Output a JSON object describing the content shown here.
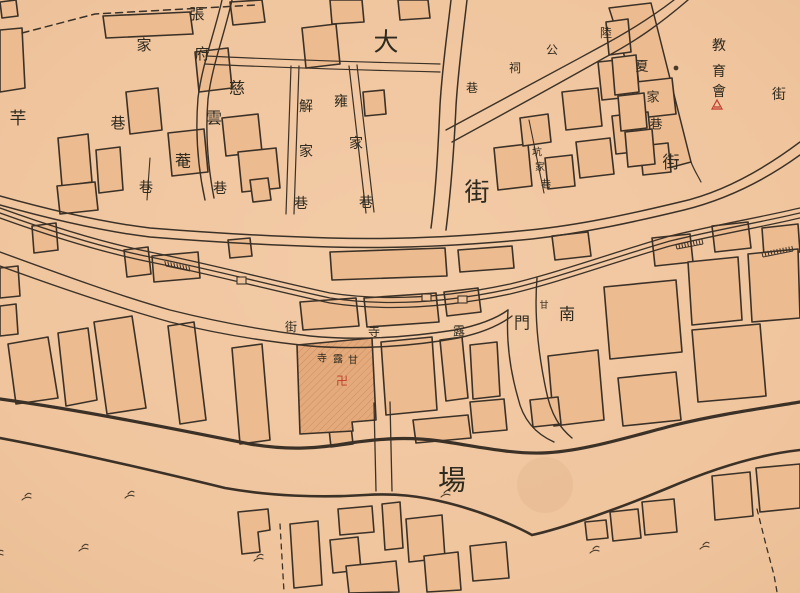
{
  "map": {
    "type": "historical-city-map",
    "colors": {
      "paper": "#f0c59e",
      "paper_light": "#f2cba6",
      "ink": "#3b3127",
      "label_ink": "#2f2a1f",
      "building_fill": "#edbb90",
      "temple_fill": "#e4aa7b",
      "accent_red": "#c03a2b"
    }
  },
  "labels": [
    {
      "id": "zhang-fu",
      "text": "張府",
      "chars": [
        {
          "t": "張",
          "x": 197,
          "y": 14,
          "s": 15
        },
        {
          "t": "府",
          "x": 202,
          "y": 54,
          "s": 15
        }
      ]
    },
    {
      "id": "ci-yun-an",
      "text": "慈雲菴",
      "chars": [
        {
          "t": "慈",
          "x": 237,
          "y": 88,
          "s": 16
        },
        {
          "t": "雲",
          "x": 214,
          "y": 118,
          "s": 16
        },
        {
          "t": "菴",
          "x": 183,
          "y": 161,
          "s": 16
        }
      ]
    },
    {
      "id": "xiang-a",
      "text": "巷",
      "chars": [
        {
          "t": "巷",
          "x": 146,
          "y": 188,
          "s": 14
        }
      ]
    },
    {
      "id": "xiang-b",
      "text": "巷",
      "chars": [
        {
          "t": "巷",
          "x": 220,
          "y": 189,
          "s": 14
        }
      ]
    },
    {
      "id": "jia-xiang",
      "text": "家巷",
      "chars": [
        {
          "t": "家",
          "x": 144,
          "y": 45,
          "s": 15
        },
        {
          "t": "巷",
          "x": 118,
          "y": 123,
          "s": 15
        }
      ]
    },
    {
      "id": "qian",
      "text": "芉",
      "chars": [
        {
          "t": "芉",
          "x": 18,
          "y": 119,
          "s": 17
        }
      ]
    },
    {
      "id": "jie-jia-xiang",
      "text": "解家巷",
      "chars": [
        {
          "t": "解",
          "x": 306,
          "y": 107,
          "s": 14
        },
        {
          "t": "家",
          "x": 306,
          "y": 152,
          "s": 14
        },
        {
          "t": "巷",
          "x": 301,
          "y": 204,
          "s": 14
        }
      ]
    },
    {
      "id": "yong-jia-xiang",
      "text": "雍家巷",
      "chars": [
        {
          "t": "雍",
          "x": 341,
          "y": 102,
          "s": 14
        },
        {
          "t": "家",
          "x": 356,
          "y": 144,
          "s": 14
        },
        {
          "t": "巷",
          "x": 366,
          "y": 203,
          "s": 14
        }
      ]
    },
    {
      "id": "da-jie",
      "text": "大街",
      "chars": [
        {
          "t": "大",
          "x": 386,
          "y": 42,
          "s": 25
        },
        {
          "t": "街",
          "x": 477,
          "y": 192,
          "s": 25
        }
      ]
    },
    {
      "id": "lu-gong-ci-xiang",
      "text": "陸公祠巷",
      "chars": [
        {
          "t": "陸",
          "x": 606,
          "y": 33,
          "s": 12
        },
        {
          "t": "公",
          "x": 552,
          "y": 50,
          "s": 12
        },
        {
          "t": "祠",
          "x": 515,
          "y": 68,
          "s": 12
        },
        {
          "t": "巷",
          "x": 472,
          "y": 88,
          "s": 12
        }
      ]
    },
    {
      "id": "keng-jia-xiang",
      "text": "坑家巷",
      "chars": [
        {
          "t": "坑",
          "x": 537,
          "y": 153,
          "s": 10
        },
        {
          "t": "家",
          "x": 540,
          "y": 168,
          "s": 10
        },
        {
          "t": "巷",
          "x": 546,
          "y": 185,
          "s": 10
        }
      ]
    },
    {
      "id": "xia-jia-xiang",
      "text": "夏家巷",
      "chars": [
        {
          "t": "夏",
          "x": 642,
          "y": 67,
          "s": 13
        },
        {
          "t": "家",
          "x": 653,
          "y": 98,
          "s": 13
        },
        {
          "t": "巷",
          "x": 656,
          "y": 125,
          "s": 13
        }
      ]
    },
    {
      "id": "jie-wedge",
      "text": "街",
      "chars": [
        {
          "t": "街",
          "x": 671,
          "y": 163,
          "s": 17
        }
      ]
    },
    {
      "id": "jiao-yu-hui",
      "text": "教育會",
      "chars": [
        {
          "t": "教",
          "x": 719,
          "y": 46,
          "s": 14
        },
        {
          "t": "育",
          "x": 719,
          "y": 72,
          "s": 14
        },
        {
          "t": "會",
          "x": 719,
          "y": 92,
          "s": 14
        }
      ]
    },
    {
      "id": "jie-right",
      "text": "街",
      "chars": [
        {
          "t": "街",
          "x": 779,
          "y": 95,
          "s": 14
        }
      ]
    },
    {
      "id": "nan-men",
      "text": "南門",
      "chars": [
        {
          "t": "南",
          "x": 567,
          "y": 314,
          "s": 16
        },
        {
          "t": "門",
          "x": 522,
          "y": 323,
          "s": 16
        }
      ]
    },
    {
      "id": "gan-lu-si-jie",
      "text": "甘露寺街",
      "chars": [
        {
          "t": "甘",
          "x": 544,
          "y": 306,
          "s": 9
        },
        {
          "t": "露",
          "x": 459,
          "y": 331,
          "s": 12
        },
        {
          "t": "寺",
          "x": 374,
          "y": 332,
          "s": 12
        },
        {
          "t": "街",
          "x": 291,
          "y": 327,
          "s": 12
        }
      ]
    },
    {
      "id": "gan-lu-si",
      "text": "甘露寺",
      "chars": [
        {
          "t": "寺",
          "x": 322,
          "y": 359,
          "s": 10
        },
        {
          "t": "露",
          "x": 338,
          "y": 360,
          "s": 10
        },
        {
          "t": "甘",
          "x": 353,
          "y": 361,
          "s": 10
        }
      ]
    },
    {
      "id": "chang",
      "text": "場",
      "chars": [
        {
          "t": "場",
          "x": 452,
          "y": 480,
          "s": 28
        }
      ]
    }
  ],
  "symbols": {
    "temple_swastika": {
      "glyph": "卍",
      "x": 342,
      "y": 381,
      "s": 12,
      "color": "#c03a2b"
    },
    "red_landmark": {
      "x": 717,
      "y": 105,
      "color": "#c03a2b"
    },
    "grass_marks": [
      [
        30,
        494
      ],
      [
        133,
        492
      ],
      [
        87,
        545
      ],
      [
        2,
        551
      ],
      [
        449,
        491
      ],
      [
        598,
        547
      ],
      [
        708,
        543
      ],
      [
        262,
        555
      ]
    ],
    "comb_marks": [
      {
        "x1": 677,
        "y1": 249,
        "x2": 703,
        "y2": 244,
        "n": 9
      },
      {
        "x1": 763,
        "y1": 257,
        "x2": 793,
        "y2": 251,
        "n": 10
      },
      {
        "x1": 166,
        "y1": 266,
        "x2": 190,
        "y2": 271,
        "n": 8
      }
    ],
    "creek_piers": [
      [
        237,
        277
      ],
      [
        422,
        294
      ],
      [
        458,
        296
      ]
    ],
    "ink_blot": {
      "x": 676,
      "y": 68,
      "r": 2.4
    },
    "stain": {
      "x": 545,
      "y": 485,
      "r": 28
    }
  }
}
